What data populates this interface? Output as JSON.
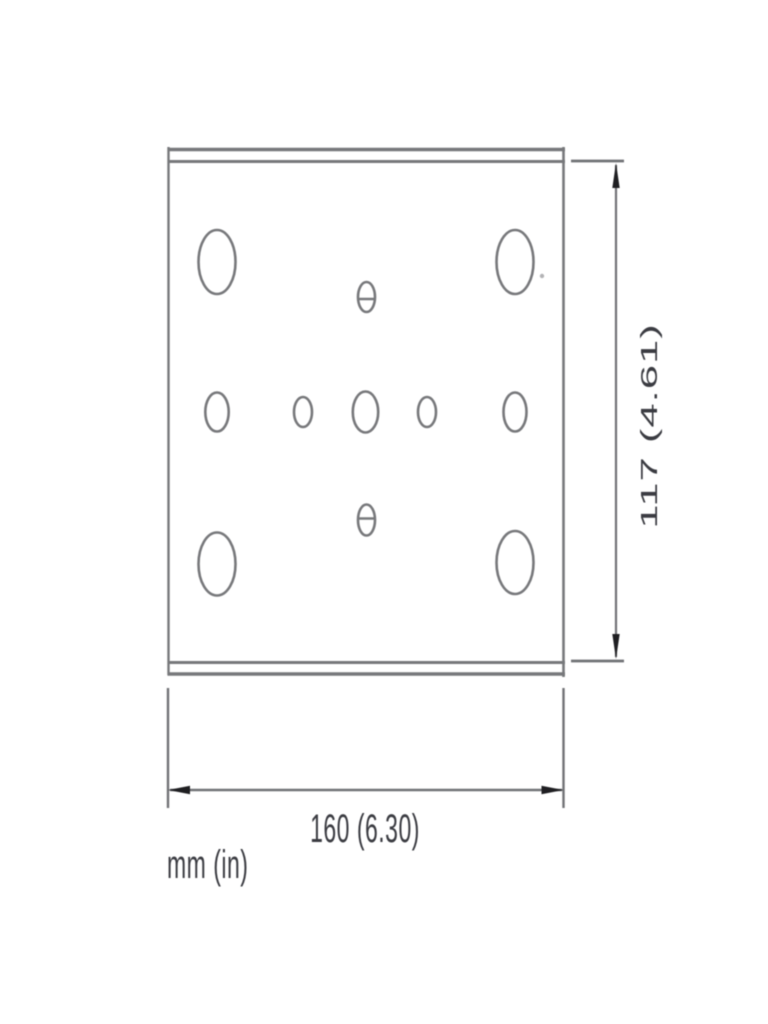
{
  "page": {
    "background": "#ffffff"
  },
  "drawing": {
    "type": "technical-dimension-drawing",
    "description": "Front view of a rectangular mounting plate with top and bottom flange lines, four large corner holes, a middle row of five holes, and two slotted center holes",
    "units_note": "mm (in)",
    "dimensions": {
      "width": {
        "label": "160 (6.30)",
        "mm": 160,
        "inches": 6.3,
        "orientation": "horizontal"
      },
      "height": {
        "label": "117 (4.61)",
        "mm": 117,
        "inches": 4.61,
        "orientation": "vertical"
      }
    },
    "holes": {
      "large_corner_holes": 4,
      "middle_row_holes": 5,
      "slotted_center_holes": 2
    },
    "colors": {
      "line": "#77787b",
      "dimension_line": "#717276",
      "arrow": "#1f1f22",
      "text": "#3b3c42"
    }
  }
}
